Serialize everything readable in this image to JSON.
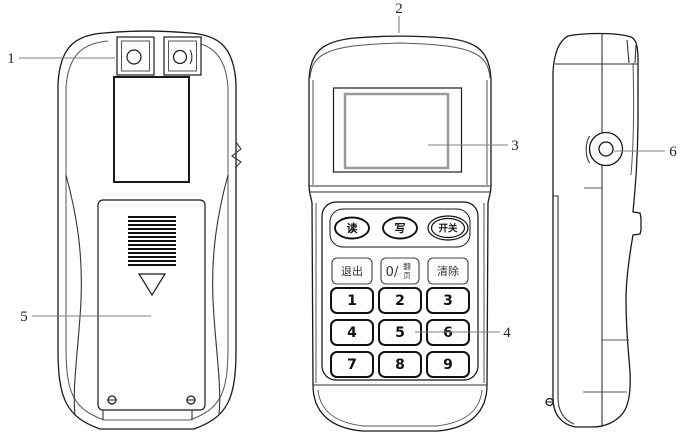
{
  "colors": {
    "background": "#ffffff",
    "line": "#1a1a1a",
    "secondary_line": "#8a8a8a",
    "screen_frame": "#999999"
  },
  "callouts": [
    {
      "number": "1"
    },
    {
      "number": "2"
    },
    {
      "number": "3"
    },
    {
      "number": "4"
    },
    {
      "number": "5"
    },
    {
      "number": "6"
    }
  ],
  "front_view": {
    "oval_buttons": [
      {
        "label": "读"
      },
      {
        "label": "写"
      },
      {
        "label": "开关"
      }
    ],
    "function_keys": {
      "exit": "退出",
      "zero_prefix": "0/",
      "page_top": "翻",
      "page_bottom": "页",
      "clear": "清除"
    },
    "number_keys": [
      "1",
      "2",
      "3",
      "4",
      "5",
      "6",
      "7",
      "8",
      "9"
    ]
  }
}
